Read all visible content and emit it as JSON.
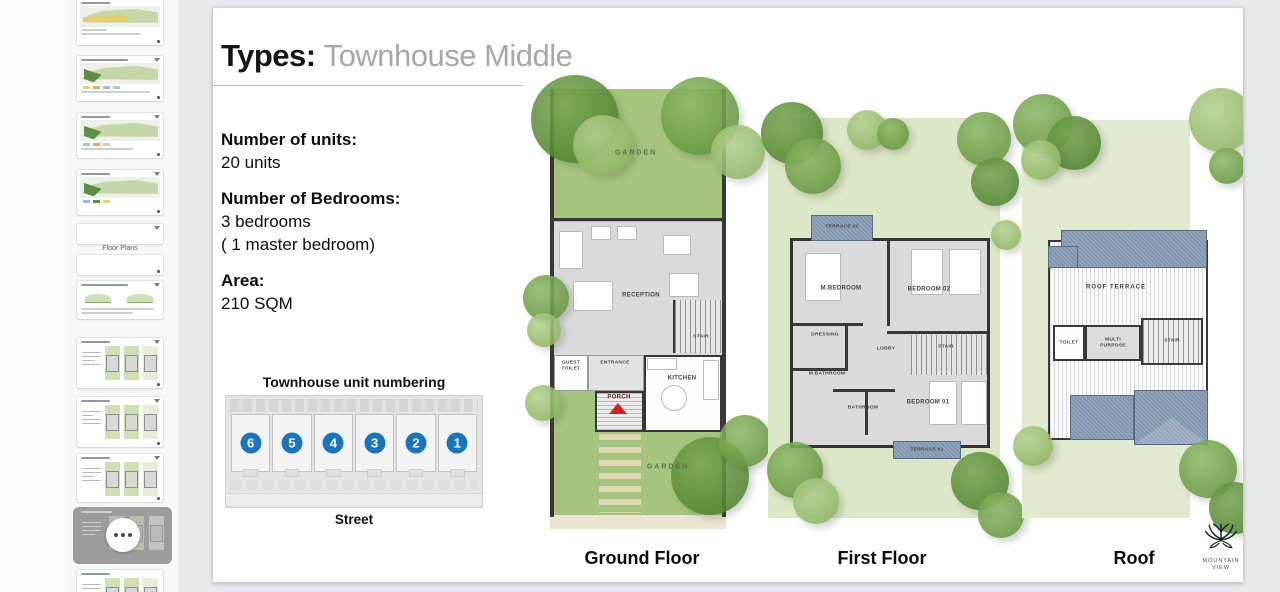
{
  "sidebar": {
    "floor_plans_label": "Floor Plans"
  },
  "slide": {
    "title_prefix": "Types:",
    "title_value": "Townhouse Middle",
    "info": {
      "units_label": "Number of units:",
      "units_value": "20 units",
      "bedrooms_label": "Number of Bedrooms:",
      "bedrooms_value": "3 bedrooms",
      "bedrooms_note": "( 1 master bedroom)",
      "area_label": "Area:",
      "area_value": "210 SQM"
    },
    "numbering": {
      "title": "Townhouse unit numbering",
      "street": "Street",
      "units": [
        "6",
        "5",
        "4",
        "3",
        "2",
        "1"
      ]
    },
    "ground": {
      "label": "Ground Floor",
      "garden_top": "GARDEN",
      "reception": "RECEPTION",
      "stair": "STAIR",
      "guest_toilet": "GUEST TOILET",
      "entrance": "ENTRANCE",
      "porch": "PORCH",
      "kitchen": "KITCHEN",
      "garden_bottom": "GARDEN"
    },
    "first": {
      "label": "First Floor",
      "terrace_02": "TERRACE 02",
      "m_bedroom": "M.BEDROOM",
      "bedroom_02": "BEDROOM 02",
      "dressing": "DRESSING",
      "lobby": "LOBBY",
      "stair": "STAIR",
      "m_bathroom": "M.BATHROOM",
      "bathroom": "BATHROOM",
      "bedroom_01": "BEDROOM 01",
      "terrace_01": "TERRACE 01"
    },
    "roof": {
      "label": "Roof",
      "roof_terrace": "ROOF TERRACE",
      "toilet": "TOILET",
      "multi_purpose": "MULTI PURPOSE",
      "stair": "STAIR"
    },
    "logo": {
      "line1": "MOUNTAIN",
      "line2": "VIEW"
    }
  },
  "colors": {
    "accent_blue": "#1b75bc",
    "garden_green": "#a6c47e",
    "light_green": "#dce7c8",
    "roof_blue": "#8396b0",
    "selected_thumb_gray": "#9c9c9c",
    "porch_arrow_red": "#cc2222"
  }
}
